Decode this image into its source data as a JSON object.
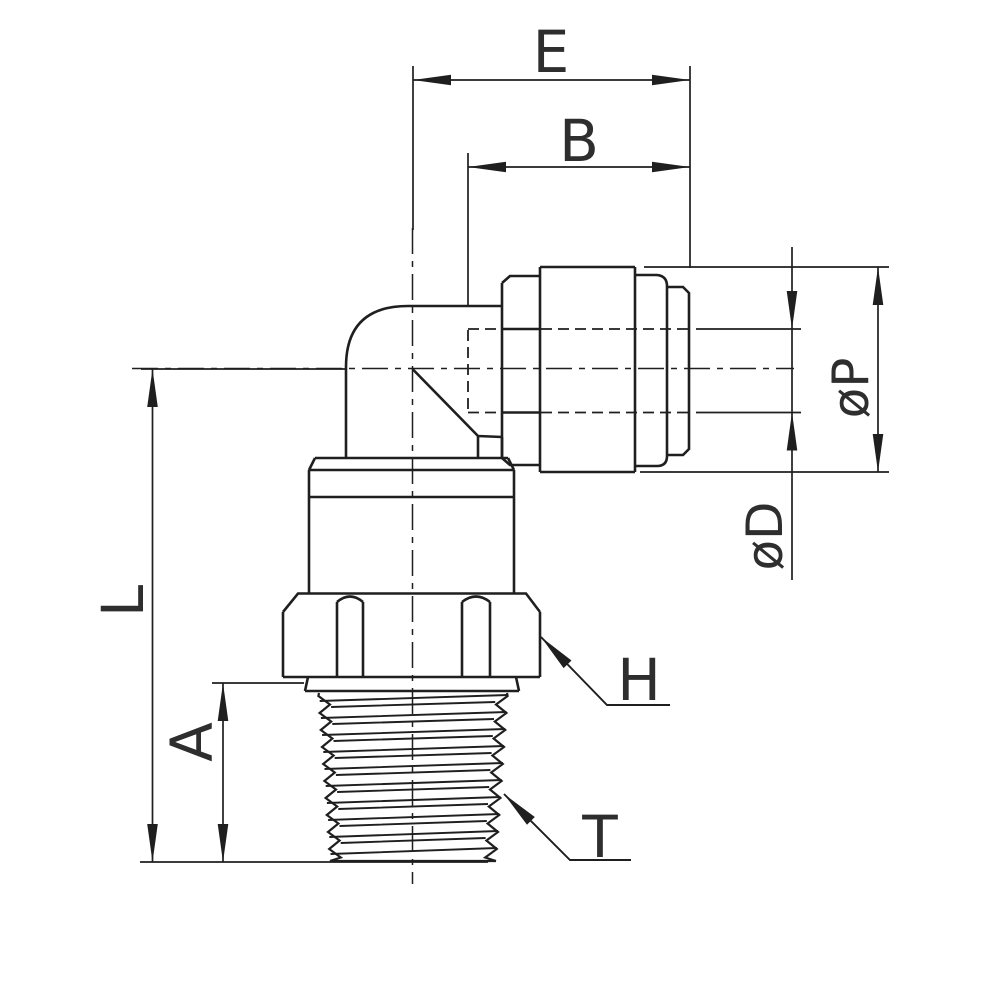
{
  "figure": {
    "background": "#ffffff",
    "stroke_color": "#1f1f1f",
    "text_color": "#2e2e2e"
  },
  "dimensions": {
    "e": {
      "label": "E"
    },
    "b": {
      "label": "B"
    },
    "p": {
      "label": "øP"
    },
    "d": {
      "label": "øD"
    },
    "l": {
      "label": "L"
    },
    "a": {
      "label": "A"
    }
  },
  "leaders": {
    "h": {
      "label": "H"
    },
    "t": {
      "label": "T"
    }
  }
}
